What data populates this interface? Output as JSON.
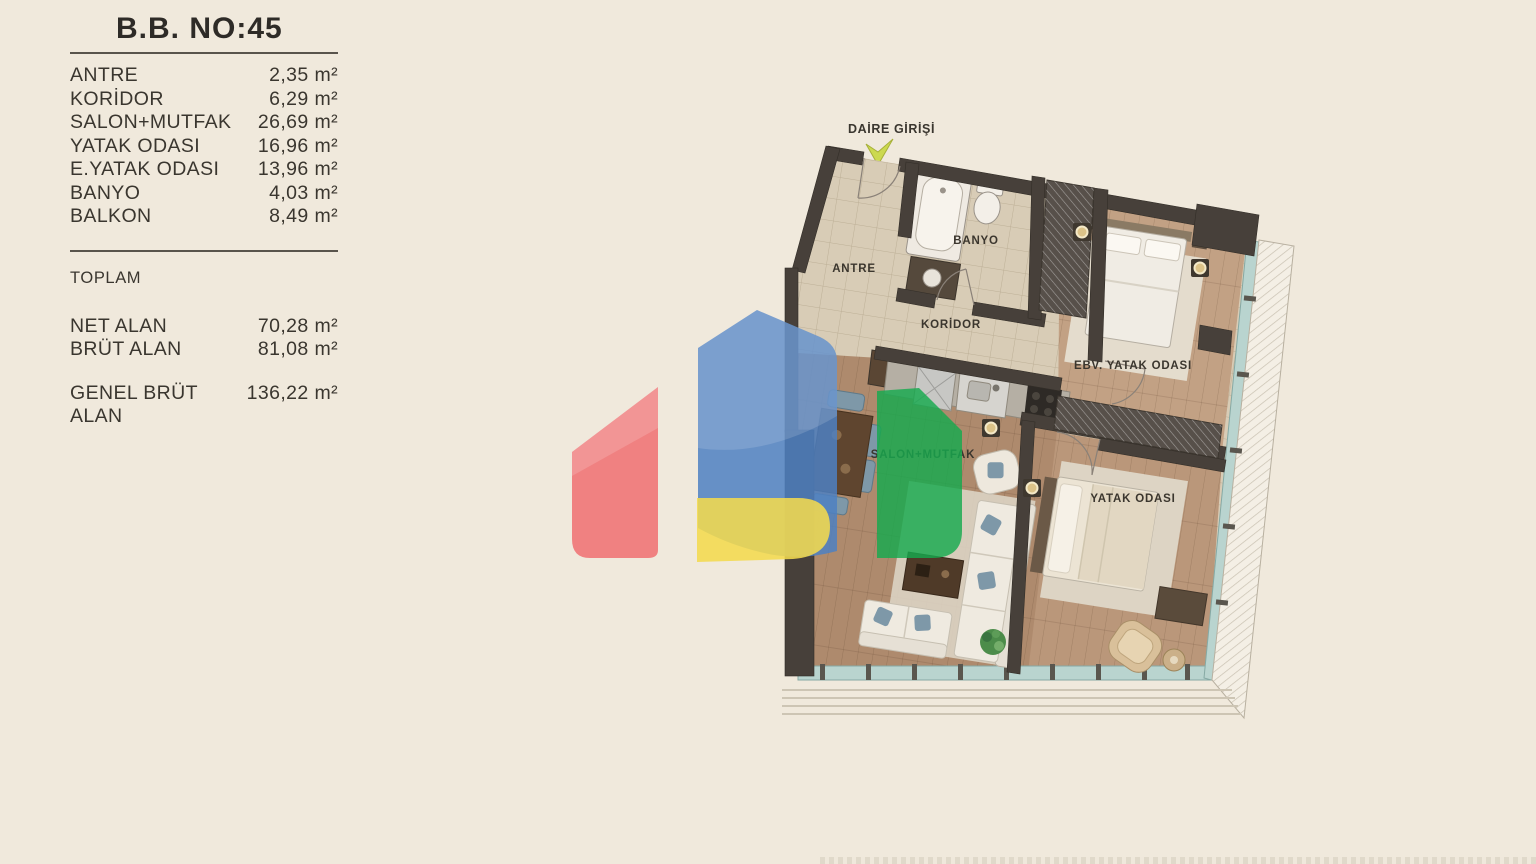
{
  "panel": {
    "title": "B.B. NO:45",
    "rooms": [
      {
        "name": "ANTRE",
        "area": "2,35 m²"
      },
      {
        "name": "KORİDOR",
        "area": "6,29 m²"
      },
      {
        "name": "SALON+MUTFAK",
        "area": "26,69 m²"
      },
      {
        "name": "YATAK ODASI",
        "area": "16,96 m²"
      },
      {
        "name": "E.YATAK ODASI",
        "area": "13,96 m²"
      },
      {
        "name": "BANYO",
        "area": "4,03 m²"
      },
      {
        "name": "BALKON",
        "area": "8,49 m²"
      }
    ],
    "toplam_label": "TOPLAM",
    "totals": [
      {
        "name": "NET ALAN",
        "area": "70,28 m²"
      },
      {
        "name": "BRÜT ALAN",
        "area": "81,08 m²"
      }
    ],
    "genel": {
      "name": "GENEL BRÜT ALAN",
      "area": "136,22 m²"
    }
  },
  "plan": {
    "entrance_label": "DAİRE GİRİŞİ",
    "labels": {
      "antre": "ANTRE",
      "banyo": "BANYO",
      "koridor": "KORİDOR",
      "master_bedroom": "EBV. YATAK ODASI",
      "salon": "SALON+MUTFAK",
      "bedroom": "YATAK ODASI"
    }
  },
  "logo_colors": {
    "red": "#ef6a6d",
    "blue": "#4d80c2",
    "yellow": "#f3d94e",
    "green": "#16a94e"
  }
}
